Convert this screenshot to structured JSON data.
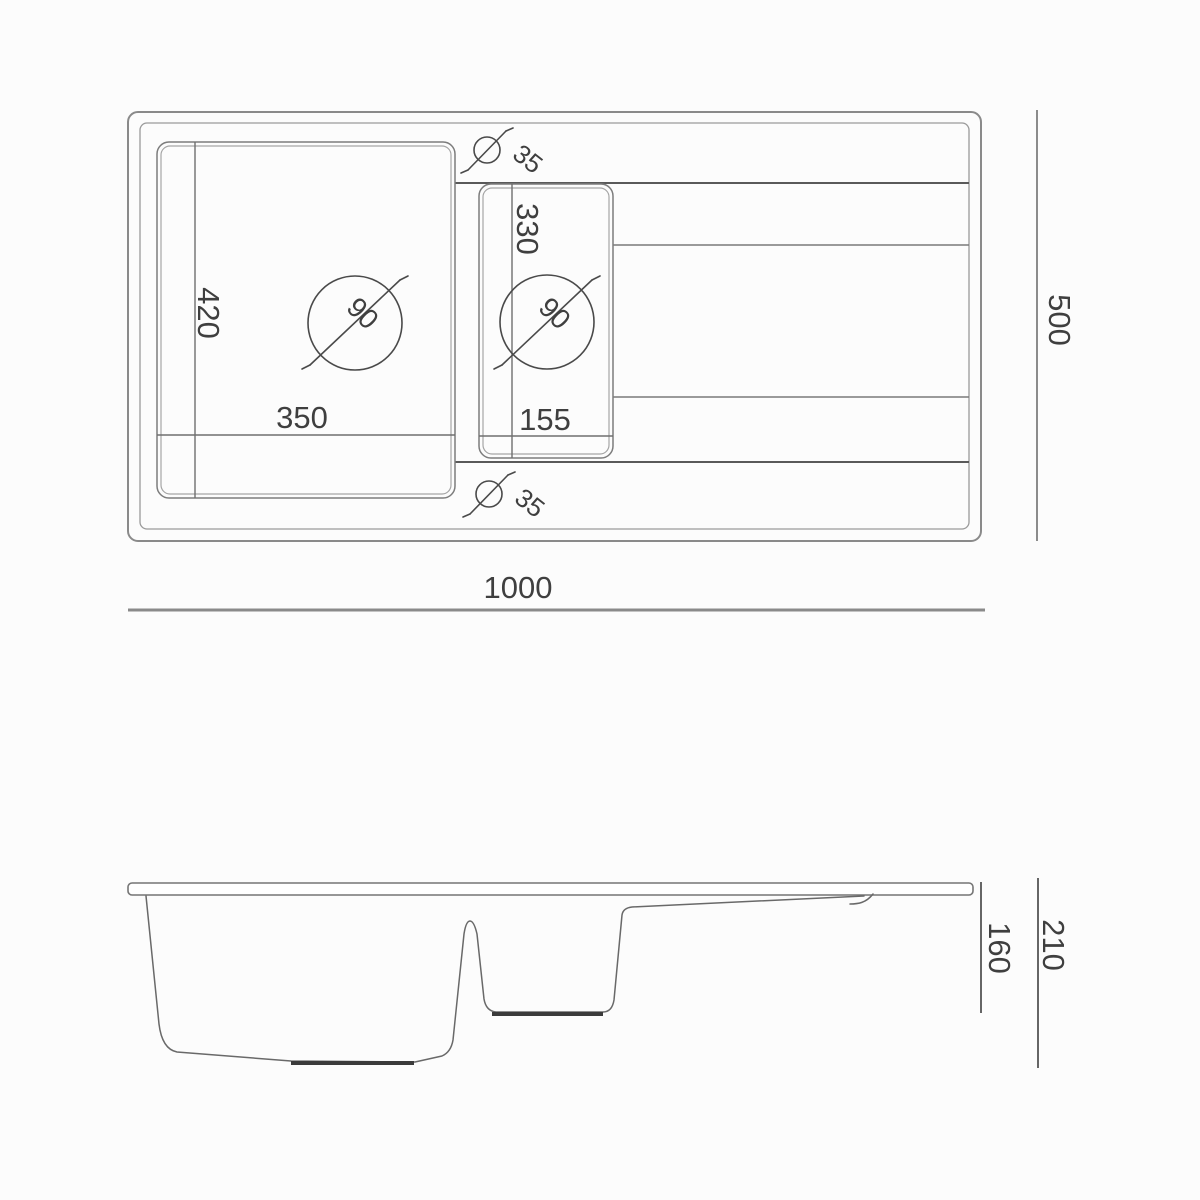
{
  "top_view": {
    "width_label": "1000",
    "depth_label": "500",
    "main_bowl": {
      "width": "350",
      "depth": "420",
      "drain_hole_diameter": "35",
      "drain_circle_diameter": "90"
    },
    "small_bowl": {
      "width": "155",
      "depth": "330",
      "drain_hole_diameter": "35",
      "drain_circle_diameter": "90"
    }
  },
  "side_view": {
    "total_height": "210",
    "bowl_depth": "160"
  },
  "colors": {
    "background": "#fcfcfc",
    "line_light": "#9a9a9a",
    "line_medium": "#6f6f6f",
    "line_dark": "#4a4a4a",
    "text": "#3f3f3f"
  }
}
